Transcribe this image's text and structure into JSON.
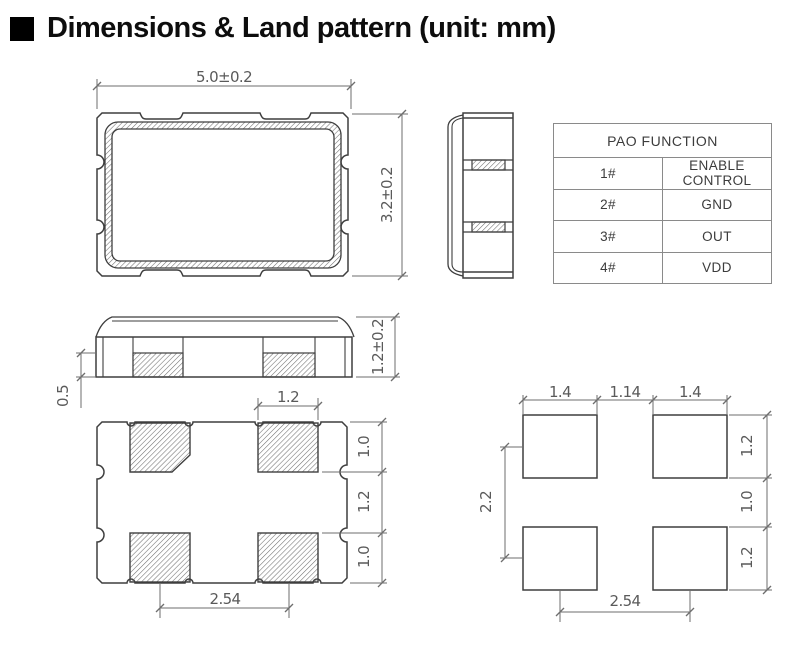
{
  "title": "Dimensions & Land pattern (unit: mm)",
  "top_view": {
    "width_dim": "5.0±0.2",
    "height_dim": "3.2±0.2"
  },
  "front_view": {
    "total_height_dim": "1.2±0.2",
    "pad_height_dim": "0.5"
  },
  "bottom_view": {
    "pad_width_dim": "1.2",
    "row_height_top_dim": "1.0",
    "row_gap_dim": "1.2",
    "row_height_bottom_dim": "1.0",
    "pad_pitch_dim": "2.54"
  },
  "land_pattern": {
    "pad_width_left_dim": "1.4",
    "pad_gap_dim": "1.14",
    "pad_width_right_dim": "1.4",
    "pad_height_top_dim": "1.2",
    "row_gap_dim": "1.0",
    "pad_height_bottom_dim": "1.2",
    "vertical_pitch_dim": "2.2",
    "horizontal_pitch_dim": "2.54"
  },
  "pin_table": {
    "header": "PAO FUNCTION",
    "rows": [
      {
        "pin": "1#",
        "function": "ENABLE CONTROL"
      },
      {
        "pin": "2#",
        "function": "GND"
      },
      {
        "pin": "3#",
        "function": "OUT"
      },
      {
        "pin": "4#",
        "function": "VDD"
      }
    ]
  }
}
